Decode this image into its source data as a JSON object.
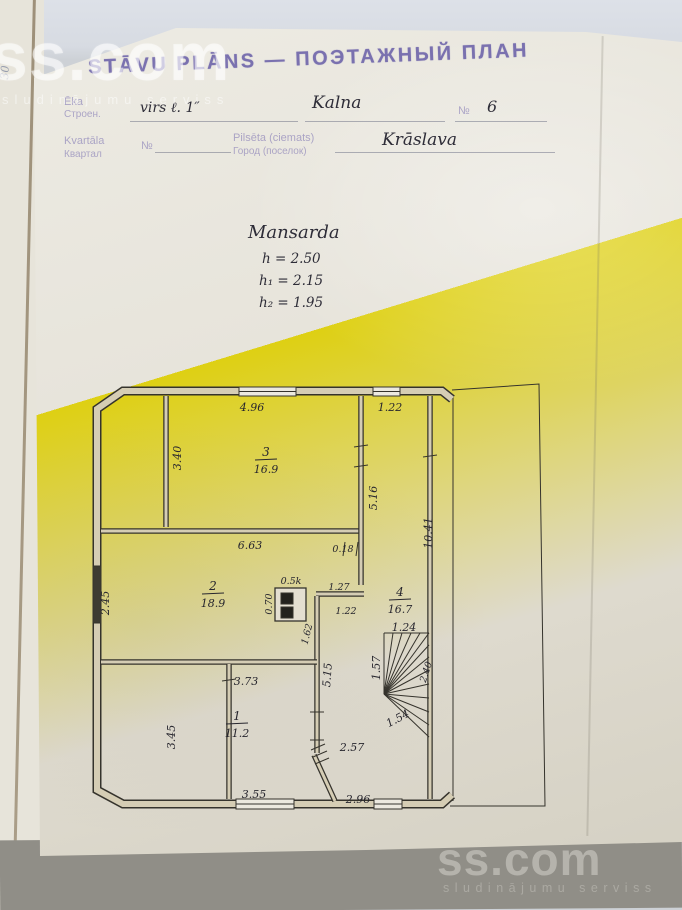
{
  "colors": {
    "stamp_ink": "#6257a5",
    "pencil_ink": "#27262e",
    "paper": "#e6e3da",
    "wall_fill": "#d5cdb4",
    "scanner_gray": "#908e87"
  },
  "watermark": {
    "brand": "ss.com",
    "tagline": "sludinājumu serviss"
  },
  "page": {
    "margin_note": "30"
  },
  "stamp": {
    "title_lv": "STĀVU PLĀNS",
    "separator": "—",
    "title_ru": "ПОЭТАЖНЫЙ ПЛАН"
  },
  "form": {
    "building_label_lv": "Ēka",
    "building_label_ru": "Строен.",
    "building_value": "virs ℓ. 1″",
    "street_value": "Kalna",
    "number_label": "№",
    "number_value": "6",
    "block_label_lv": "Kvartāla",
    "block_label_ru": "Квартал",
    "block_no_label": "№",
    "city_label_lv": "Pilsēta (ciemats)",
    "city_label_ru": "Город (поселок)",
    "city_value": "Krāslava"
  },
  "notes": {
    "floor_name": "Mansarda",
    "heights": [
      {
        "text": "h = 2.50"
      },
      {
        "text": "h₁ = 2.15"
      },
      {
        "text": "h₂ = 1.95"
      }
    ]
  },
  "plan": {
    "rooms": [
      {
        "number": "1",
        "area": "11.2"
      },
      {
        "number": "2",
        "area": "18.9"
      },
      {
        "number": "3",
        "area": "16.9"
      },
      {
        "number": "4",
        "area": "16.7"
      }
    ],
    "dims": {
      "w_top": "4.96",
      "w_top_right": "1.22",
      "h_room3_left": "3.40",
      "h_corridor_upper": "5.16",
      "h_corridor_full": "10.41",
      "w_wall_a": "6.63",
      "t_wall": "0.18",
      "h_left_mid": "2.45",
      "chimney": "0.5k",
      "chimney_w": "0.70",
      "w_jog": "1.27",
      "w_door": "1.22",
      "h_wall_mid": "1.62",
      "w_stairs": "1.24",
      "h_stairs_left": "1.57",
      "stairs_diag": "2.40",
      "h_wall_lower": "5.15",
      "w_room1_top": "3.73",
      "h_room1_left": "3.45",
      "stairs_lower": "1.54",
      "hall": "2.57",
      "w_bottom_left": "3.55",
      "w_bottom_right": "2.96"
    }
  }
}
